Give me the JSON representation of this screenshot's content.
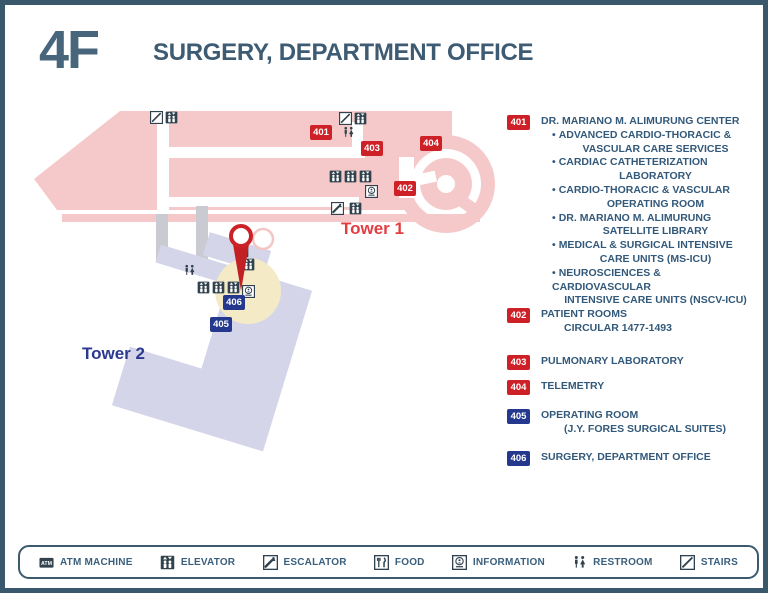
{
  "header": {
    "floor": "4F",
    "title": "SURGERY, DEPARTMENT OFFICE"
  },
  "map": {
    "tower1_label": "Tower 1",
    "tower2_label": "Tower 2",
    "icons": [
      {
        "type": "stairs",
        "x": 145,
        "y": 106
      },
      {
        "type": "elevator",
        "x": 160,
        "y": 106
      },
      {
        "type": "stairs",
        "x": 334,
        "y": 107
      },
      {
        "type": "elevator",
        "x": 349,
        "y": 107
      },
      {
        "type": "restroom",
        "x": 337,
        "y": 121
      },
      {
        "type": "elevator",
        "x": 324,
        "y": 165
      },
      {
        "type": "elevator",
        "x": 339,
        "y": 165
      },
      {
        "type": "elevator",
        "x": 354,
        "y": 165
      },
      {
        "type": "information",
        "x": 360,
        "y": 180
      },
      {
        "type": "escalator",
        "x": 326,
        "y": 197
      },
      {
        "type": "elevator",
        "x": 344,
        "y": 197
      },
      {
        "type": "restroom",
        "x": 178,
        "y": 259
      },
      {
        "type": "elevator",
        "x": 231,
        "y": 240
      },
      {
        "type": "elevator",
        "x": 237,
        "y": 253
      },
      {
        "type": "elevator",
        "x": 192,
        "y": 276
      },
      {
        "type": "elevator",
        "x": 207,
        "y": 276
      },
      {
        "type": "elevator",
        "x": 222,
        "y": 276
      },
      {
        "type": "information",
        "x": 237,
        "y": 280
      }
    ],
    "badges": [
      {
        "label": "401",
        "color": "red",
        "x": 305,
        "y": 120
      },
      {
        "label": "403",
        "color": "red",
        "x": 356,
        "y": 136
      },
      {
        "label": "404",
        "color": "red",
        "x": 415,
        "y": 131
      },
      {
        "label": "402",
        "color": "red",
        "x": 389,
        "y": 176
      },
      {
        "label": "406",
        "color": "blue",
        "x": 218,
        "y": 290
      },
      {
        "label": "405",
        "color": "blue",
        "x": 205,
        "y": 312
      }
    ]
  },
  "rooms": [
    {
      "num": "401",
      "color": "red",
      "lines": [
        "DR. MARIANO M. ALIMURUNG CENTER"
      ],
      "bullets": [
        [
          "ADVANCED CARDIO-THORACIC &",
          "VASCULAR CARE SERVICES"
        ],
        [
          "CARDIAC CATHETERIZATION",
          "LABORATORY"
        ],
        [
          "CARDIO-THORACIC & VASCULAR",
          "OPERATING ROOM"
        ],
        [
          "DR. MARIANO M. ALIMURUNG",
          "SATELLITE LIBRARY"
        ],
        [
          "MEDICAL & SURGICAL INTENSIVE",
          "CARE UNITS (MS-ICU)"
        ],
        [
          "NEUROSCIENCES & CARDIOVASCULAR",
          "INTENSIVE CARE UNITS (NSCV-ICU)"
        ]
      ]
    },
    {
      "num": "402",
      "color": "red",
      "lines": [
        "PATIENT ROOMS",
        "CIRCULAR 1477-1493"
      ],
      "bullets": []
    },
    {
      "num": "403",
      "color": "red",
      "lines": [
        "PULMONARY LABORATORY"
      ],
      "bullets": []
    },
    {
      "num": "404",
      "color": "red",
      "lines": [
        "TELEMETRY"
      ],
      "bullets": []
    },
    {
      "num": "405",
      "color": "blue",
      "lines": [
        "OPERATING ROOM",
        "(J.Y. FORES SURGICAL SUITES)"
      ],
      "bullets": []
    },
    {
      "num": "406",
      "color": "blue",
      "lines": [
        "SURGERY, DEPARTMENT OFFICE"
      ],
      "bullets": []
    }
  ],
  "legend": [
    {
      "icon": "atm",
      "label": "ATM MACHINE"
    },
    {
      "icon": "elevator",
      "label": "ELEVATOR"
    },
    {
      "icon": "escalator",
      "label": "ESCALATOR"
    },
    {
      "icon": "food",
      "label": "FOOD"
    },
    {
      "icon": "information",
      "label": "INFORMATION"
    },
    {
      "icon": "restroom",
      "label": "RESTROOM"
    },
    {
      "icon": "stairs",
      "label": "STAIRS"
    }
  ],
  "colors": {
    "red": "#CE2027",
    "blue": "#24388E",
    "slate": "#3C5A6E",
    "pink": "#F5C9C9",
    "lavender": "#D5D5E9",
    "yellow": "#F4EBC6",
    "corridor_gray": "#C9CAD2",
    "pin_red": "#C32026",
    "tower1_text": "#E23D41",
    "tower2_text": "#2B3990",
    "icon_dark": "#31424E"
  }
}
